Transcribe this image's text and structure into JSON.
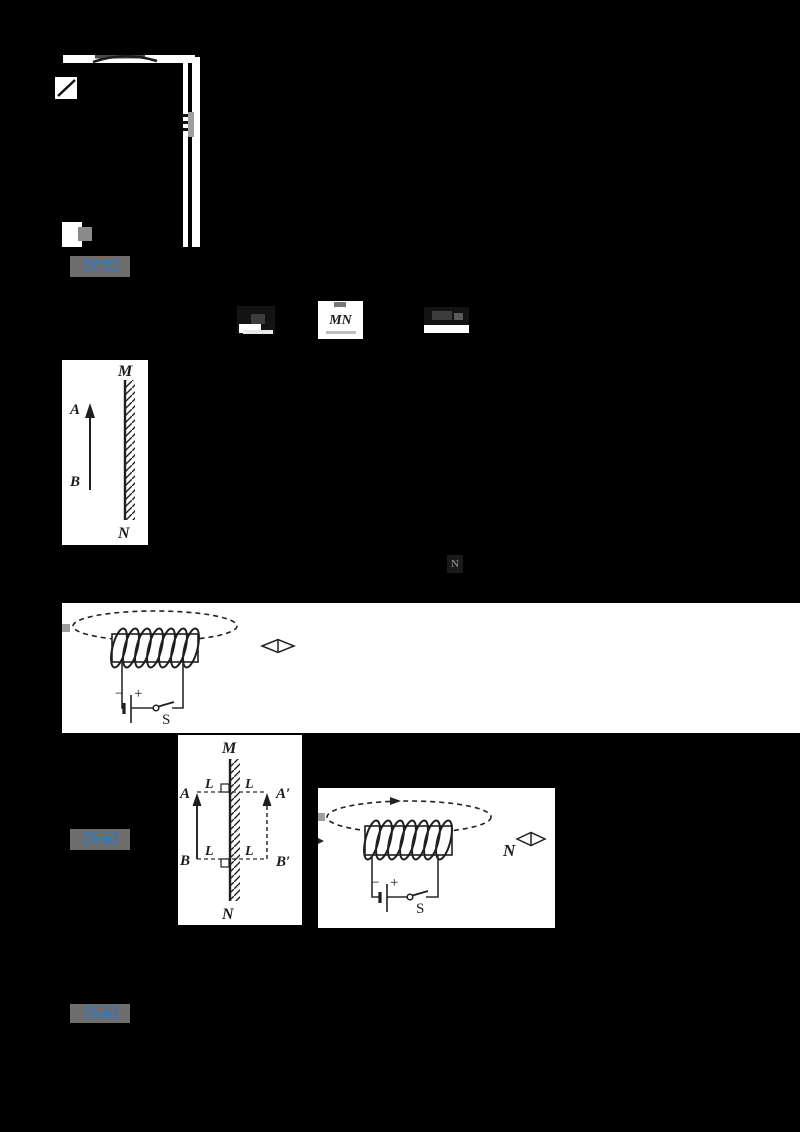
{
  "colors": {
    "background": "#000000",
    "figure_bg": "#ffffff",
    "ink": "#1f1f1f",
    "accent_blue": "#2e78c4",
    "highlight_gray": "#6d6d6d",
    "fragment_gray": "#9e9e9e"
  },
  "answer_labels": [
    {
      "text": "【答案】"
    },
    {
      "text": "【答案】"
    },
    {
      "text": "【答案】"
    }
  ],
  "inline_images": {
    "formula_mn": {
      "text": "MN"
    },
    "formula_n": {
      "text": "N"
    }
  },
  "fig_mirror_object": {
    "mirror_top": "M",
    "mirror_bottom": "N",
    "arrow_head_label": "A",
    "arrow_tail_label": "B"
  },
  "fig_solenoid_open": {
    "battery_minus": "−",
    "battery_plus": "+",
    "switch_label": "S"
  },
  "fig_mirror_image": {
    "mirror_top": "M",
    "mirror_bottom": "N",
    "object_head": "A",
    "object_tail": "B",
    "image_head": "A′",
    "image_tail": "B′",
    "dist_top_left": "L",
    "dist_top_right": "L",
    "dist_bottom_left": "L",
    "dist_bottom_right": "L"
  },
  "fig_solenoid_needle": {
    "battery_minus": "−",
    "battery_plus": "+",
    "switch_label": "S",
    "pole_label": "N"
  }
}
